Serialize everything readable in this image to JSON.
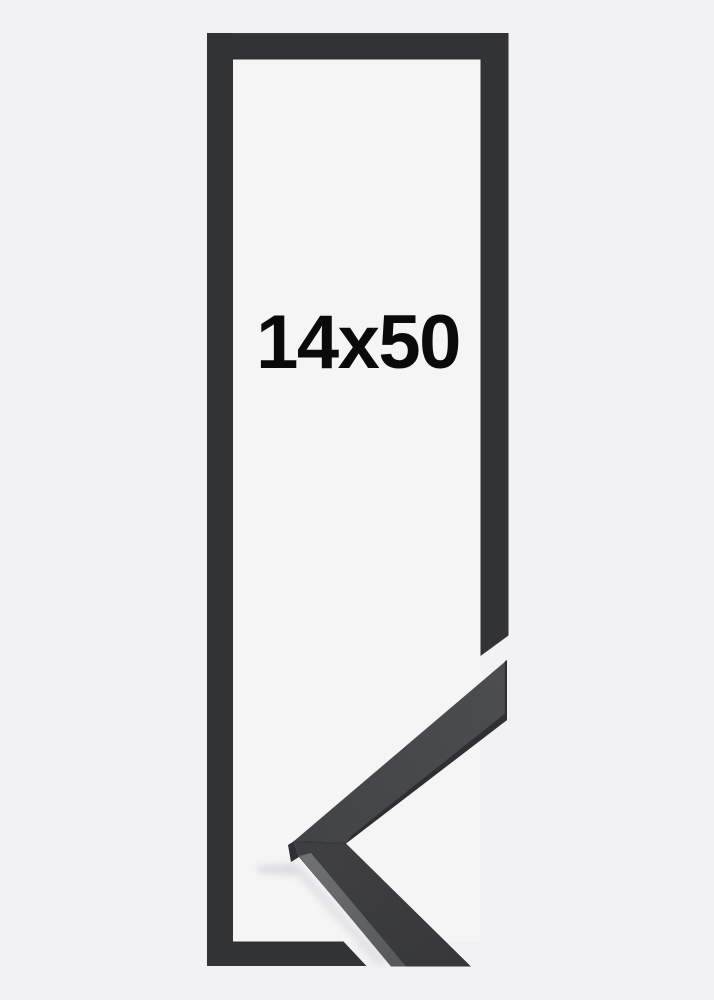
{
  "scene": {
    "size_label": "14x50",
    "colors": {
      "background": "#f2f2f4",
      "inner_background": "#f5f5f6",
      "frame": "#313335",
      "frame_edge_light": "#3c3d3f",
      "moulding_top_light": "#47494b",
      "moulding_top_dark": "#3d3f41",
      "moulding_front_light": "#3a3b3d",
      "moulding_front_dark": "#323335",
      "moulding_highlight_light": "#6d6f71",
      "moulding_highlight_dark": "#525456",
      "moulding_edge_dark": "#26282a",
      "moulding_end_face": "#2a2b2d",
      "miter_seam": "#232527",
      "shadow": "#c8c8cc",
      "label_color": "#0a0a0b"
    }
  }
}
